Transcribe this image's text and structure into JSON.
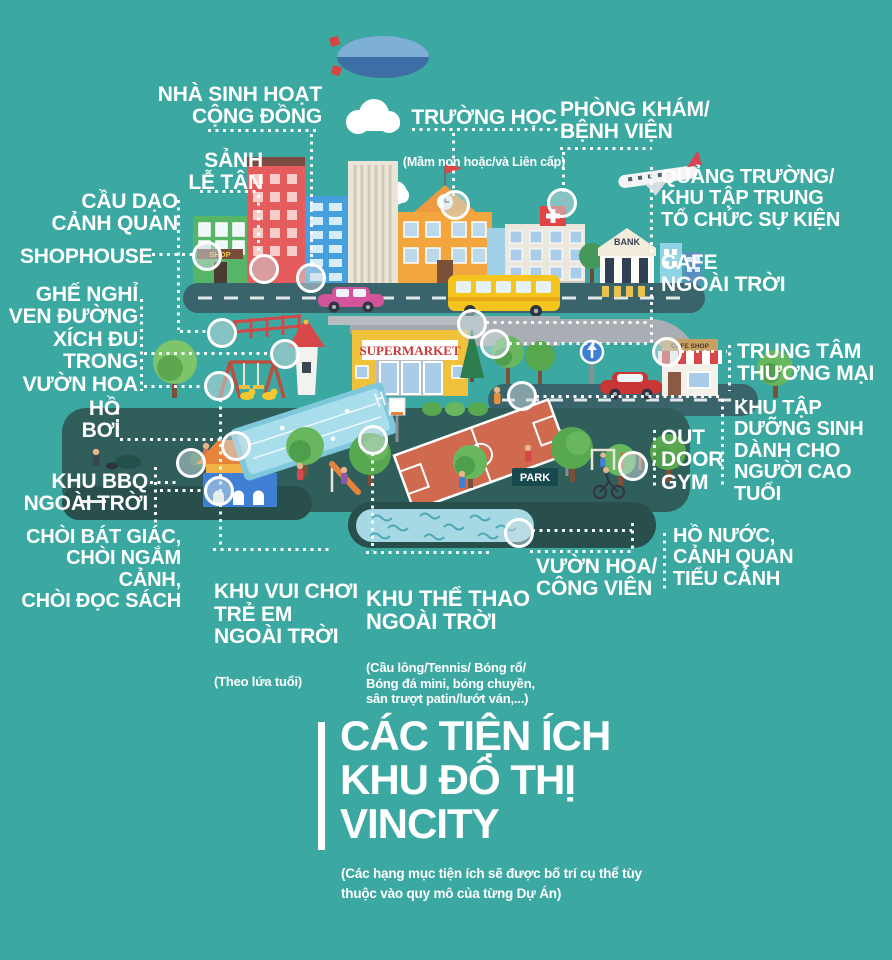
{
  "title": {
    "text": "CÁC TIỆN ÍCH\nKHU ĐÔ THỊ\nVINCITY",
    "note": "(Các hạng mục tiện ích sẽ được bố trí cụ thể tùy\nthuộc vào quy mô của từng Dự Án)"
  },
  "labels": {
    "nha_sinh_hoat": {
      "text": "NHÀ SINH HOẠT\nCỘNG ĐỒNG"
    },
    "truong_hoc": {
      "text": "TRƯỜNG HỌC",
      "sub": "(Mầm non hoặc/và Liên cấp)"
    },
    "phong_kham": {
      "text": "PHÒNG KHÁM/\nBỆNH VIỆN"
    },
    "sanh_le_tan": {
      "text": "SẢNH\nLỄ TÂN"
    },
    "cau_dao": {
      "text": "CẦU DẠO\nCẢNH QUAN"
    },
    "shophouse": {
      "text": "SHOPHOUSE"
    },
    "quang_truong": {
      "text": "QUẢNG TRƯỜNG/\nKHU TẬP TRUNG\nTỔ CHỨC SỰ KIỆN"
    },
    "cafe_ngoai_troi": {
      "text": "CAFE\nNGOÀI TRỜI"
    },
    "ghe_nghi": {
      "text": "GHẾ NGHỈ\nVEN ĐƯỜNG\nXÍCH ĐU\nTRONG\nVƯỜN HOA"
    },
    "trung_tam": {
      "text": "TRUNG TÂM\nTHƯƠNG MẠI"
    },
    "khu_tap": {
      "text": "KHU TẬP\nDƯỠNG SINH\nDÀNH CHO\nNGƯỜI CAO TUỔI"
    },
    "ho_boi": {
      "text": "HỒ\nBƠI"
    },
    "outdoor_gym": {
      "text": "OUT\nDOOR\nGYM"
    },
    "khu_bbq": {
      "text": "KHU BBQ\nNGOÀI TRỜI"
    },
    "choi": {
      "text": "CHÒI BÁT GIÁC,\nCHÒI NGẮM CẢNH,\nCHÒI ĐỌC SÁCH"
    },
    "khu_vui_choi": {
      "text": "KHU VUI CHƠI\nTRẺ EM\nNGOÀI TRỜI",
      "sub": "(Theo lứa tuổi)"
    },
    "khu_the_thao": {
      "text": "KHU THỂ THAO\nNGOÀI TRỜI",
      "sub": "(Cầu lông/Tennis/ Bóng rổ/\nBóng đá mini, bóng chuyền,\nsân trượt patin/lướt ván,...)"
    },
    "vuon_hoa": {
      "text": "VƯỜN HOA/\nCÔNG VIÊN"
    },
    "ho_nuoc": {
      "text": "HỒ NƯỚC,\nCẢNH QUAN\nTIỂU CẢNH"
    }
  },
  "illustration": {
    "supermarket_sign": "SUPERMARKET",
    "bank_sign": "BANK",
    "park_sign": "PARK",
    "shop_sign": "SHOP",
    "cafe_shop_sign": "CAFE SHOP"
  },
  "colors": {
    "background": "#3BA8A1",
    "road": "#3A646C",
    "park_ground": "#2F5E5B",
    "label_text": "#FFFFFF",
    "supermarket_yellow": "#F0C23C",
    "bus_yellow": "#F6C51D",
    "court_orange": "#CF6A4E",
    "pool_blue": "#A8DDEC",
    "accent_red": "#D84848"
  }
}
